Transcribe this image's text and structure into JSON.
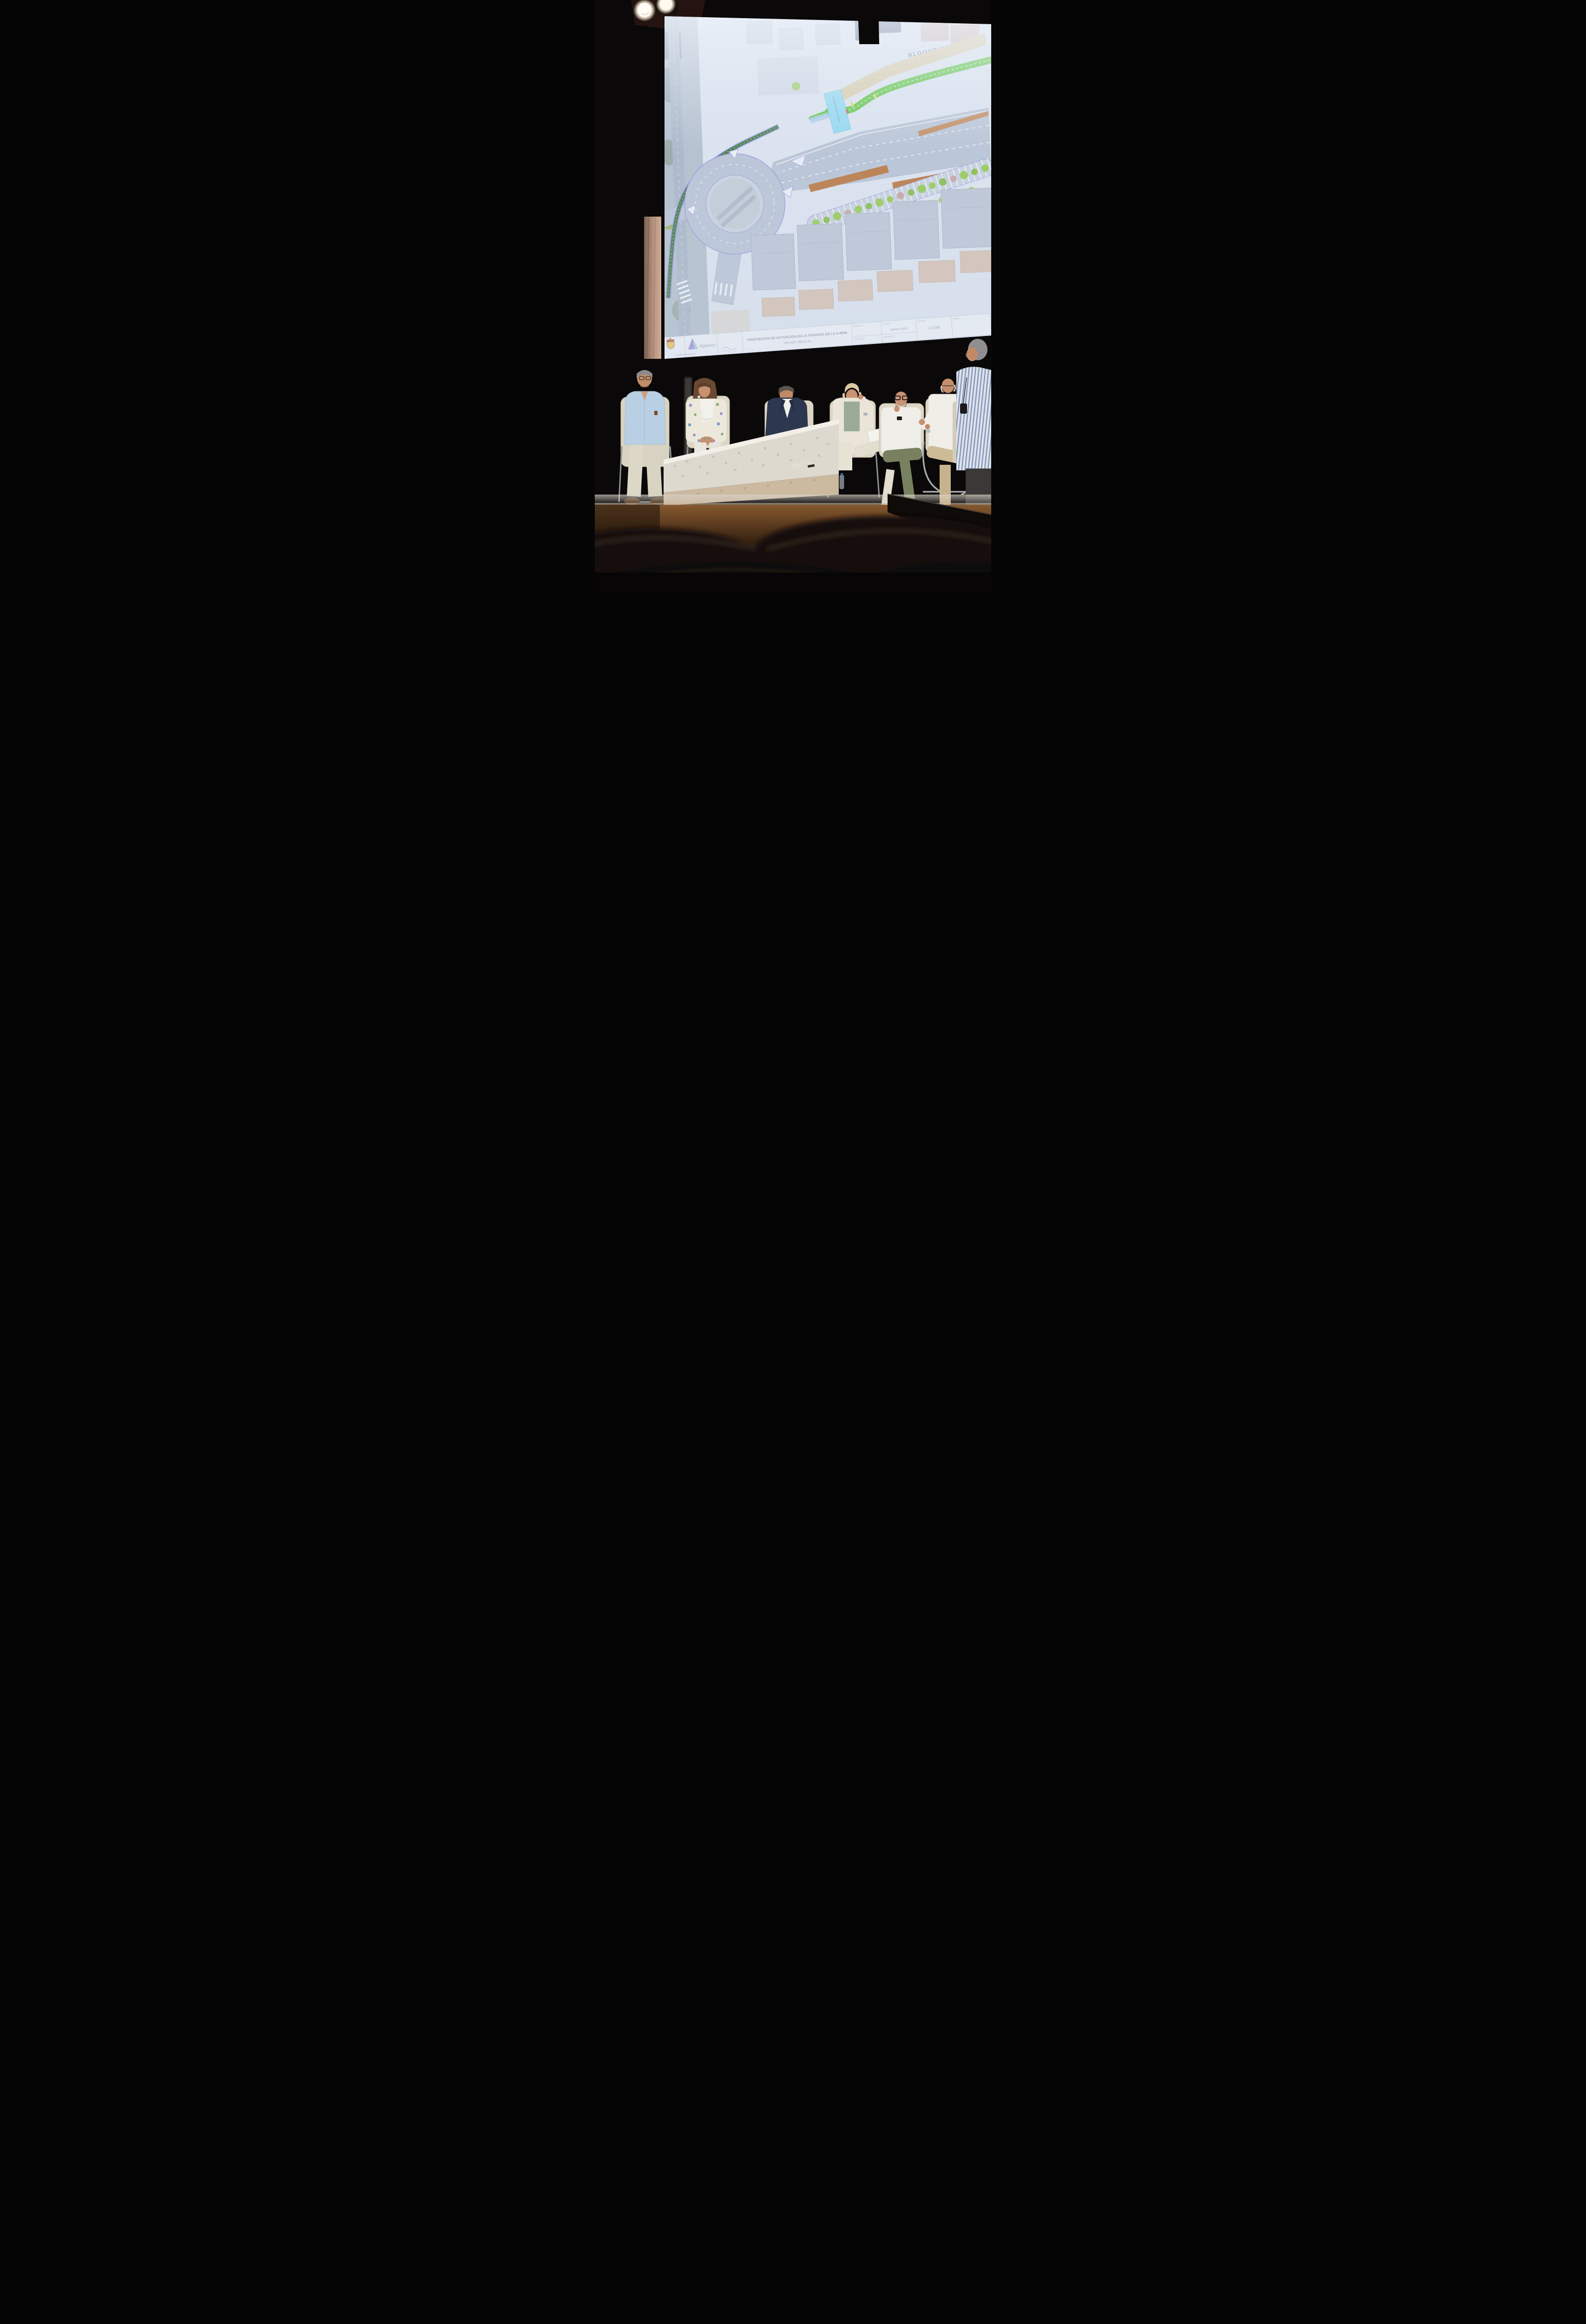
{
  "scene": {
    "description": "Panel discussion on an auditorium stage in front of a projected urban roadway plan",
    "location_shown_on_plan": "Gelves (Sevilla)"
  },
  "projection": {
    "block_header": "BLOQUE 3",
    "title_block": {
      "project_title_line1": "PROPUESTAS DE ACTUACION EN LA TRAVESIA DE LA A-8058",
      "project_title_line2": "GELVES (SEVILLA)",
      "cells": [
        {
          "label": "BLOQUE 4",
          "value": ""
        },
        {
          "label": "FECHA",
          "value": "MARZO 2023"
        },
        {
          "label": "ESCALA",
          "value": "1/2.000"
        },
        {
          "label": "PLANO",
          "value": ""
        }
      ],
      "sub_labels": [
        "SUPERFICIE",
        "DELINEANTE"
      ],
      "logos": [
        {
          "name": "gelves-crest",
          "caption": "Ayuntamiento de Gelves"
        },
        {
          "name": "aguesur-logo",
          "caption": "Aguesur"
        }
      ]
    },
    "plan_features": {
      "roundabout": true,
      "bike_lane_color": "#4cc02e",
      "median_color": "#b5713a",
      "parking_with_trees": true
    }
  },
  "panel": {
    "panelists": [
      {
        "id": 1,
        "description": "man, gray hair, glasses, light blue shirt, cream trousers"
      },
      {
        "id": 2,
        "description": "woman, long curly brown hair, floral blazer, white top and trousers"
      },
      {
        "id": 3,
        "description": "man, navy blazer, white shirt, gray trousers, legs crossed"
      },
      {
        "id": 4,
        "description": "woman, short blonde hair, cream blazer, sage top, holding papers"
      },
      {
        "id": 5,
        "description": "bald man, black glasses, gray beard, white shirt, olive trousers"
      },
      {
        "id": 6,
        "description": "older bald man, glasses, white shirt, beige trousers, gesturing"
      },
      {
        "id": 7,
        "description": "man, gray hair, blue striped shirt, receiver pack, at right edge"
      }
    ],
    "furniture": [
      "cream chairs with chrome frames",
      "mosaic coffee table",
      "water bottle"
    ]
  },
  "colors": {
    "screen": "#d9e2ee",
    "road": "#b4c1d3",
    "bike_lane": "#4cc02e",
    "plan_outline": "#8f84dd",
    "stage_wood": "#6b4423",
    "curtain": "#c6a28d"
  }
}
